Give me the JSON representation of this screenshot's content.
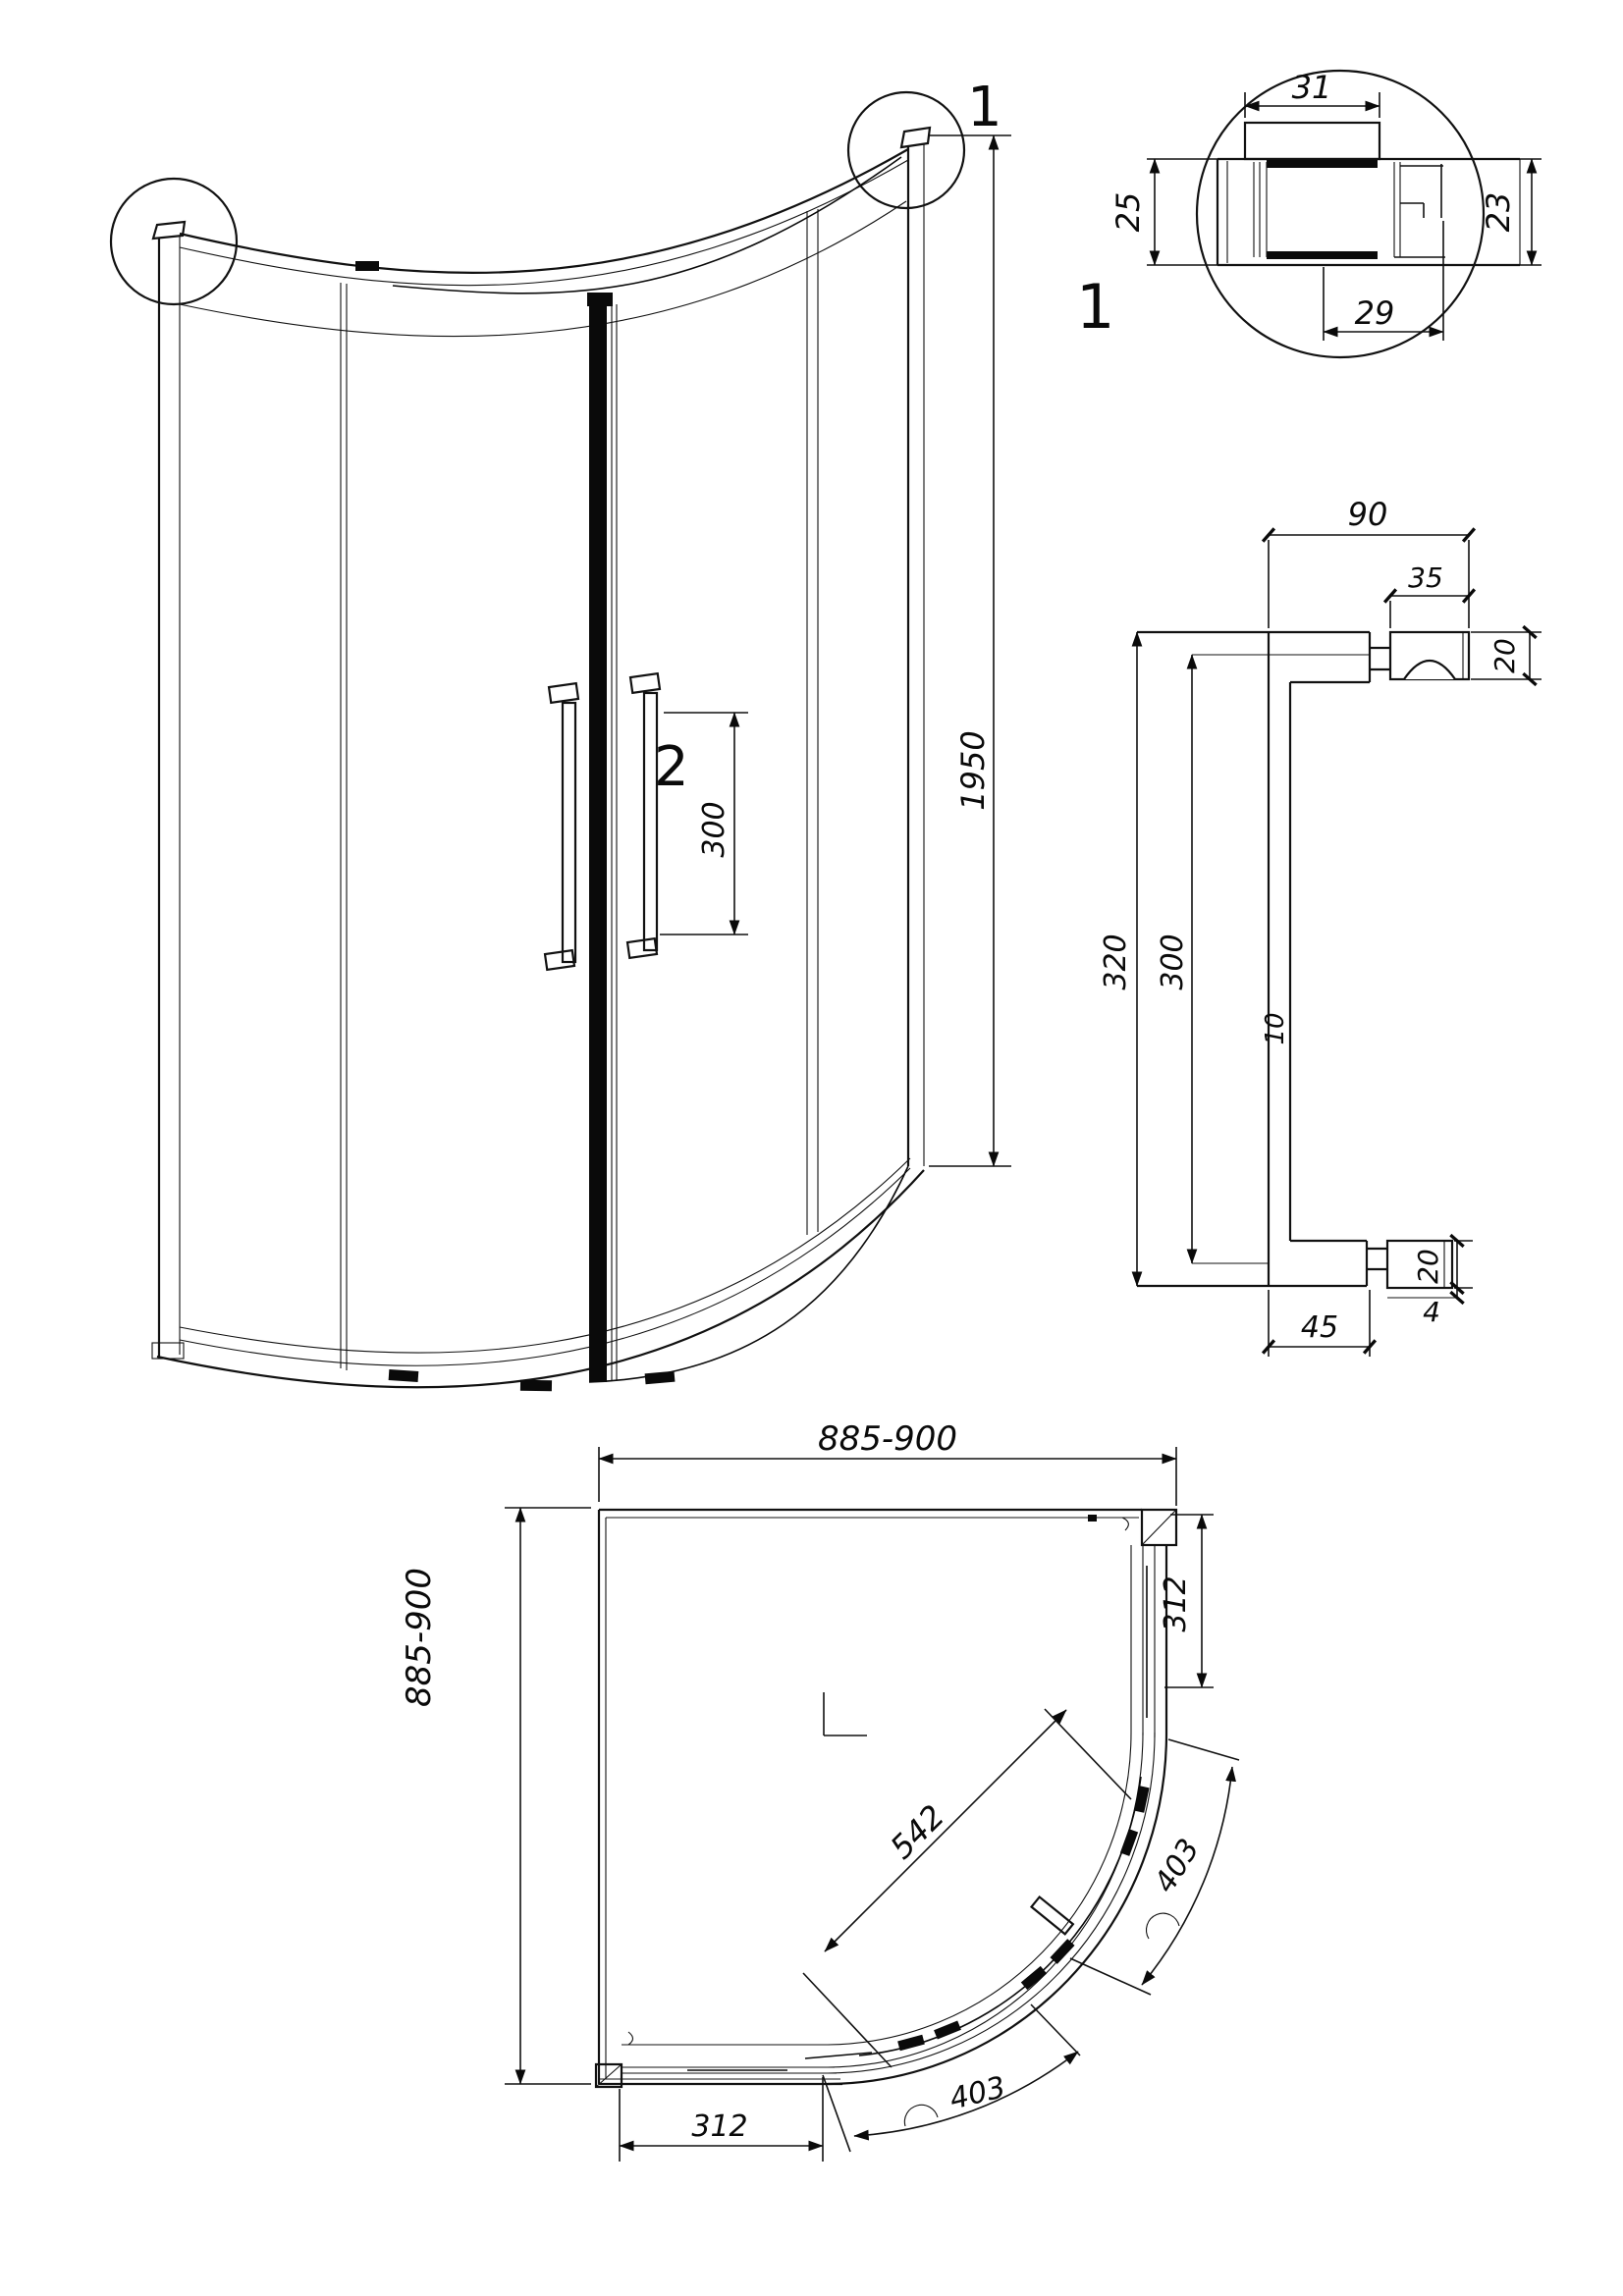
{
  "front_view": {
    "callout_top_right": "1",
    "callout_handle": "2",
    "dim_height": "1950",
    "dim_handle_spacing": "300"
  },
  "profile_detail": {
    "callout": "1",
    "dim_top_width": "31",
    "dim_left_height": "25",
    "dim_right_height": "23",
    "dim_bottom_width": "29"
  },
  "handle_detail": {
    "dim_overall_depth": "90",
    "dim_pad_width": "35",
    "dim_pad_height_top": "20",
    "dim_overall_length": "320",
    "dim_centers_length": "300",
    "dim_bar_thickness": "10",
    "dim_foot_length": "45",
    "dim_pad_height_bottom": "20",
    "dim_pad_gap": "4"
  },
  "plan_view": {
    "dim_width": "885-900",
    "dim_depth": "885-900",
    "dim_side_panel_right": "312",
    "dim_side_panel_bottom": "312",
    "dim_door_opening": "542",
    "dim_arc_right": "403",
    "dim_arc_bottom": "403"
  }
}
